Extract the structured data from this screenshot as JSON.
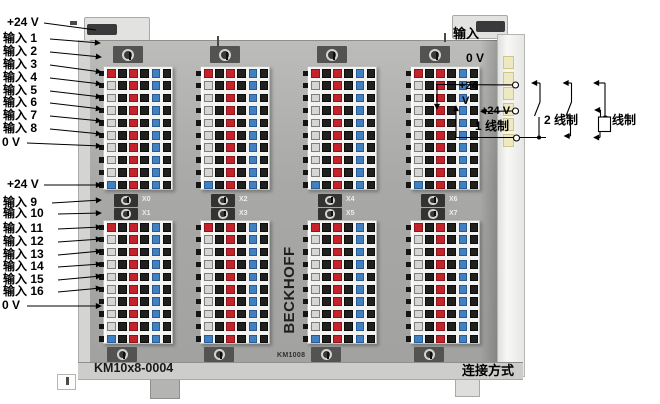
{
  "left_labels": {
    "top": [
      "+24 V",
      "输入 1",
      "输入 2",
      "输入 3",
      "输入 4",
      "输入 5",
      "输入 6",
      "输入 7",
      "输入 8",
      "0 V"
    ],
    "bottom": [
      "+24 V",
      "输入 9",
      "输入 10",
      "输入 11",
      "输入 12",
      "输入 13",
      "输入 14",
      "输入 15",
      "输入 16",
      "0 V"
    ]
  },
  "right_labels": {
    "input": "输入",
    "zero_volt": "0 V",
    "plus24_line1": "+24",
    "plus24_line2": "V",
    "plus24": "+24 V",
    "wire_1": "1 线制",
    "wire_2": "2 线制",
    "wire_3": "3 线制",
    "connection": "连接方式"
  },
  "module": {
    "brand": "BECKHOFF",
    "model": "KM1008",
    "part_number": "KM10x8-0004",
    "x_labels": [
      "X0",
      "X1",
      "X2",
      "X3",
      "X4",
      "X5",
      "X6",
      "X7"
    ]
  },
  "colors": {
    "square_red": "#c5232b",
    "square_blue": "#4281c1",
    "square_black": "#20201e",
    "square_gray": "#d6d6d4",
    "strip_bg": "#f3f3f1",
    "module_face": "#a8a8a6",
    "frame_light": "#d9d9d7",
    "contact_pad": "#efe9c2"
  },
  "terminal_pattern": {
    "rows_per_strip": 10,
    "first_column": [
      "red",
      "gray",
      "gray",
      "gray",
      "gray",
      "gray",
      "gray",
      "gray",
      "gray",
      "blue"
    ],
    "fixed_columns": [
      "black",
      "red",
      "black",
      "blue",
      "black"
    ]
  }
}
